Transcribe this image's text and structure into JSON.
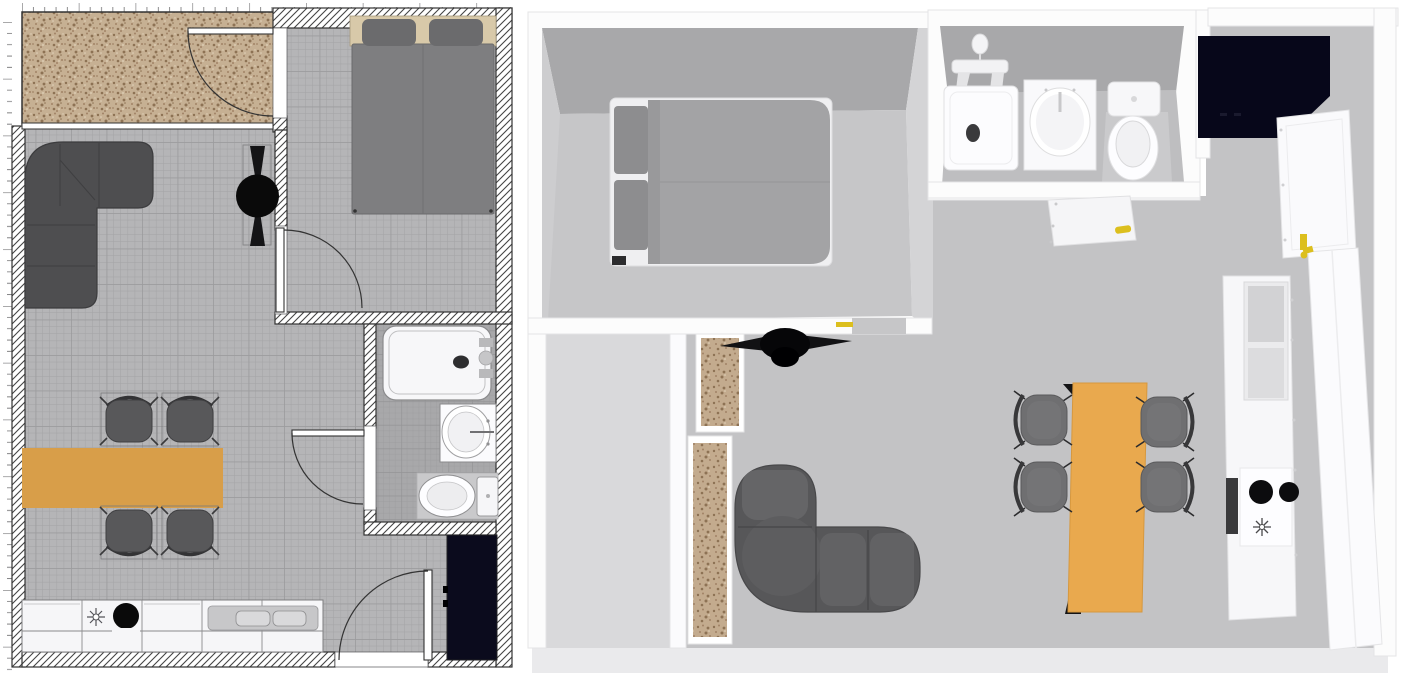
{
  "workspace": {
    "name": "home-design-workspace",
    "panes": {
      "plan2d": {
        "label": "2D floor plan",
        "has_top_ruler": true,
        "has_left_ruler": true
      },
      "view3d": {
        "label": "3D aerial view"
      }
    }
  },
  "scene": {
    "rooms": [
      {
        "name": "entry-hall",
        "floor": "cork-speckled",
        "items": [
          "entry-door-swing"
        ]
      },
      {
        "name": "bedroom",
        "floor": "gray-grid",
        "items": [
          "double-bed",
          "two-pillows",
          "headboard"
        ]
      },
      {
        "name": "living-room",
        "floor": "gray-grid",
        "items": [
          "corner-sofa",
          "ceiling-fan",
          "dining-table",
          "chair-1",
          "chair-2",
          "chair-3",
          "chair-4",
          "refrigerator"
        ]
      },
      {
        "name": "bathroom",
        "floor": "dark-gray-grid",
        "items": [
          "bathtub",
          "shower-fixture",
          "sink-vanity",
          "toilet"
        ]
      },
      {
        "name": "kitchen",
        "floor": "gray-grid",
        "items": [
          "counter-run",
          "cooktop-burner",
          "pot",
          "double-basin-sink",
          "tall-cabinets",
          "oven"
        ]
      }
    ],
    "doors": [
      {
        "name": "hall-bedroom-door",
        "state": "open-arc"
      },
      {
        "name": "living-bedroom-door",
        "state": "closed-arc"
      },
      {
        "name": "bathroom-door",
        "state": "open-arc"
      },
      {
        "name": "front-door",
        "state": "open-arc"
      }
    ],
    "handles_3d": {
      "color_name": "yellow",
      "count": 4
    }
  },
  "colors": {
    "pagebg": "#ffffff",
    "planfloor": "#b5b5b7",
    "planline": "#a6a6a8",
    "planmajor": "#9c9c9e",
    "bathfloor": "#a8a8aa",
    "bathline": "#9e9ea0",
    "corkbase": "#c6b093",
    "corkdark": "#8d7254",
    "corkmid": "#a18366",
    "corklight": "#e2d3ba",
    "wall": "#333333",
    "hatch": "#444444",
    "ruler": "#707072",
    "sofa": "#4e4e50",
    "table": "#d89e49",
    "chair": "#58585a",
    "duvet": "#7e7e80",
    "pillow": "#6b6b6d",
    "headboard": "#d8c9a9",
    "fixture": "#f7f7f9",
    "fixstroke": "#8a8a8c",
    "fridge": "#0b0b1d",
    "fan": "#0a0a0a",
    "v3floor": "#c3c3c5",
    "v3white": "#fcfcfc",
    "v3edge": "#e4e4e6",
    "v3dark": "#a8a8aa",
    "v3mid": "#cdcdcf",
    "v3light": "#d9d9db",
    "v3sofa": "#575759",
    "v3table": "#e9a94e",
    "v3chair": "#6f6f71",
    "v3bed": "#a3a3a5",
    "v3pillow": "#8d8d8f",
    "yellow": "#dcbf1e",
    "v3fridge": "#07071a",
    "slab": "#eaeaec"
  }
}
